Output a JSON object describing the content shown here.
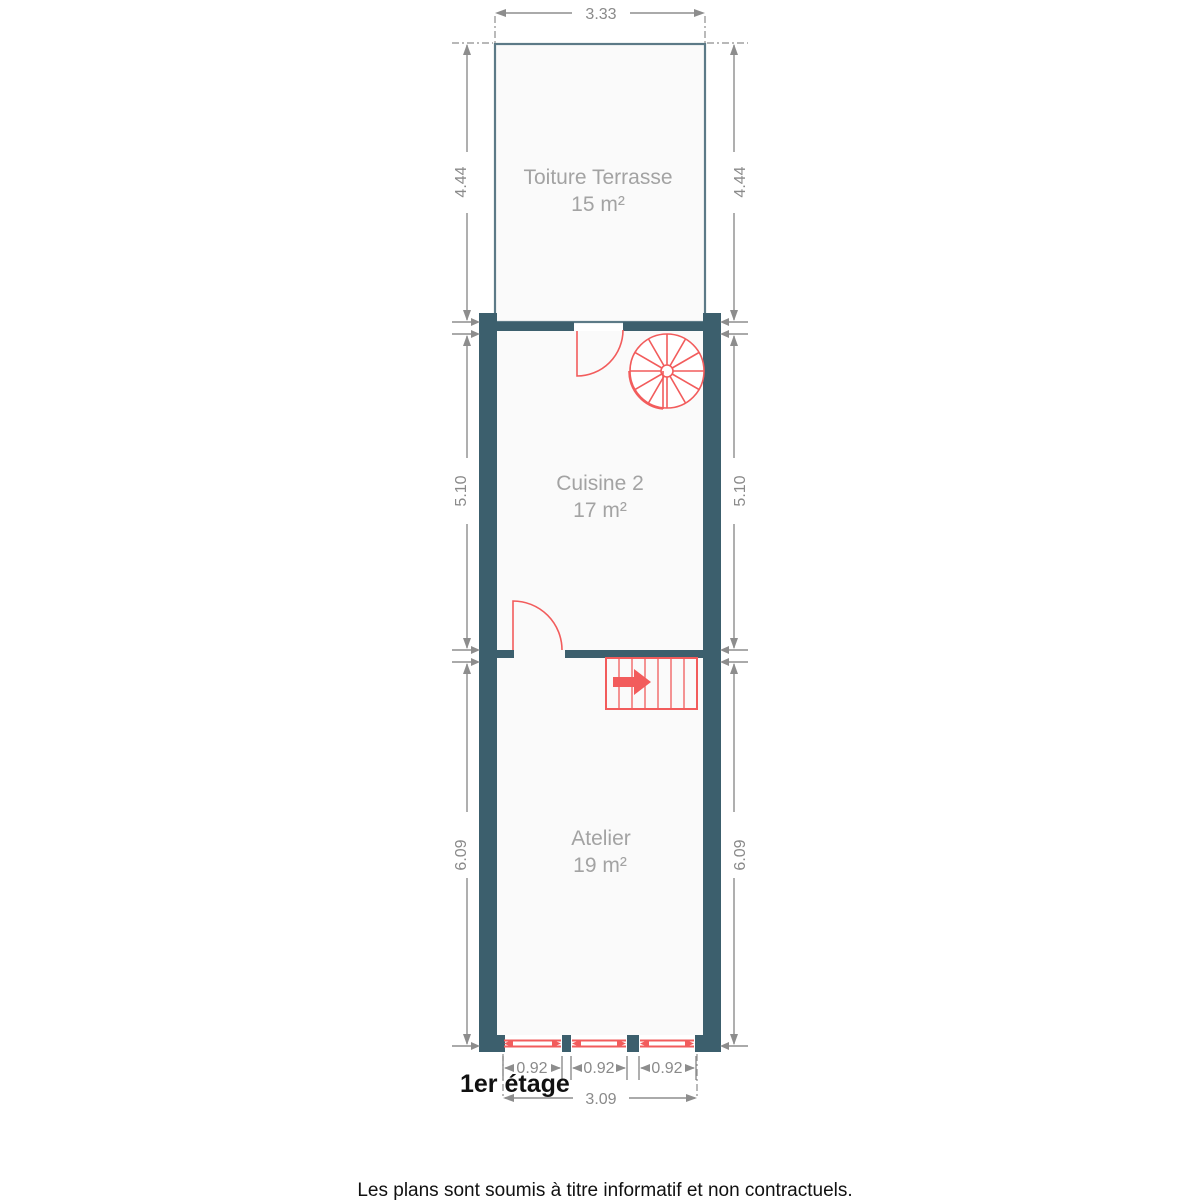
{
  "floor_plan": {
    "floor_label": "1er étage",
    "disclaimer": "Les plans sont soumis à titre informatif et non contractuels.",
    "rooms": [
      {
        "name": "Toiture Terrasse",
        "area": "15 m²"
      },
      {
        "name": "Cuisine 2",
        "area": "17 m²"
      },
      {
        "name": "Atelier",
        "area": "19 m²"
      }
    ],
    "dimensions": {
      "terrace_width": "3.33",
      "terrace_depth": "4.44",
      "kitchen_depth": "5.10",
      "workshop_depth": "6.09",
      "window_width": "0.92",
      "facade_width": "3.09"
    },
    "features": {
      "spiral_staircase": "spiral staircase (kitchen, upper right)",
      "straight_staircase": "staircase with direction arrow (workshop, top)",
      "doors": 2,
      "windows": 3
    },
    "colors": {
      "wall": "#3c5f6d",
      "thin_wall": "#5c7a87",
      "accent_red": "#f25c5c",
      "dimension_gray": "#8d8d8d",
      "room_label_gray": "#a3a3a3",
      "text_black": "#111111"
    }
  }
}
